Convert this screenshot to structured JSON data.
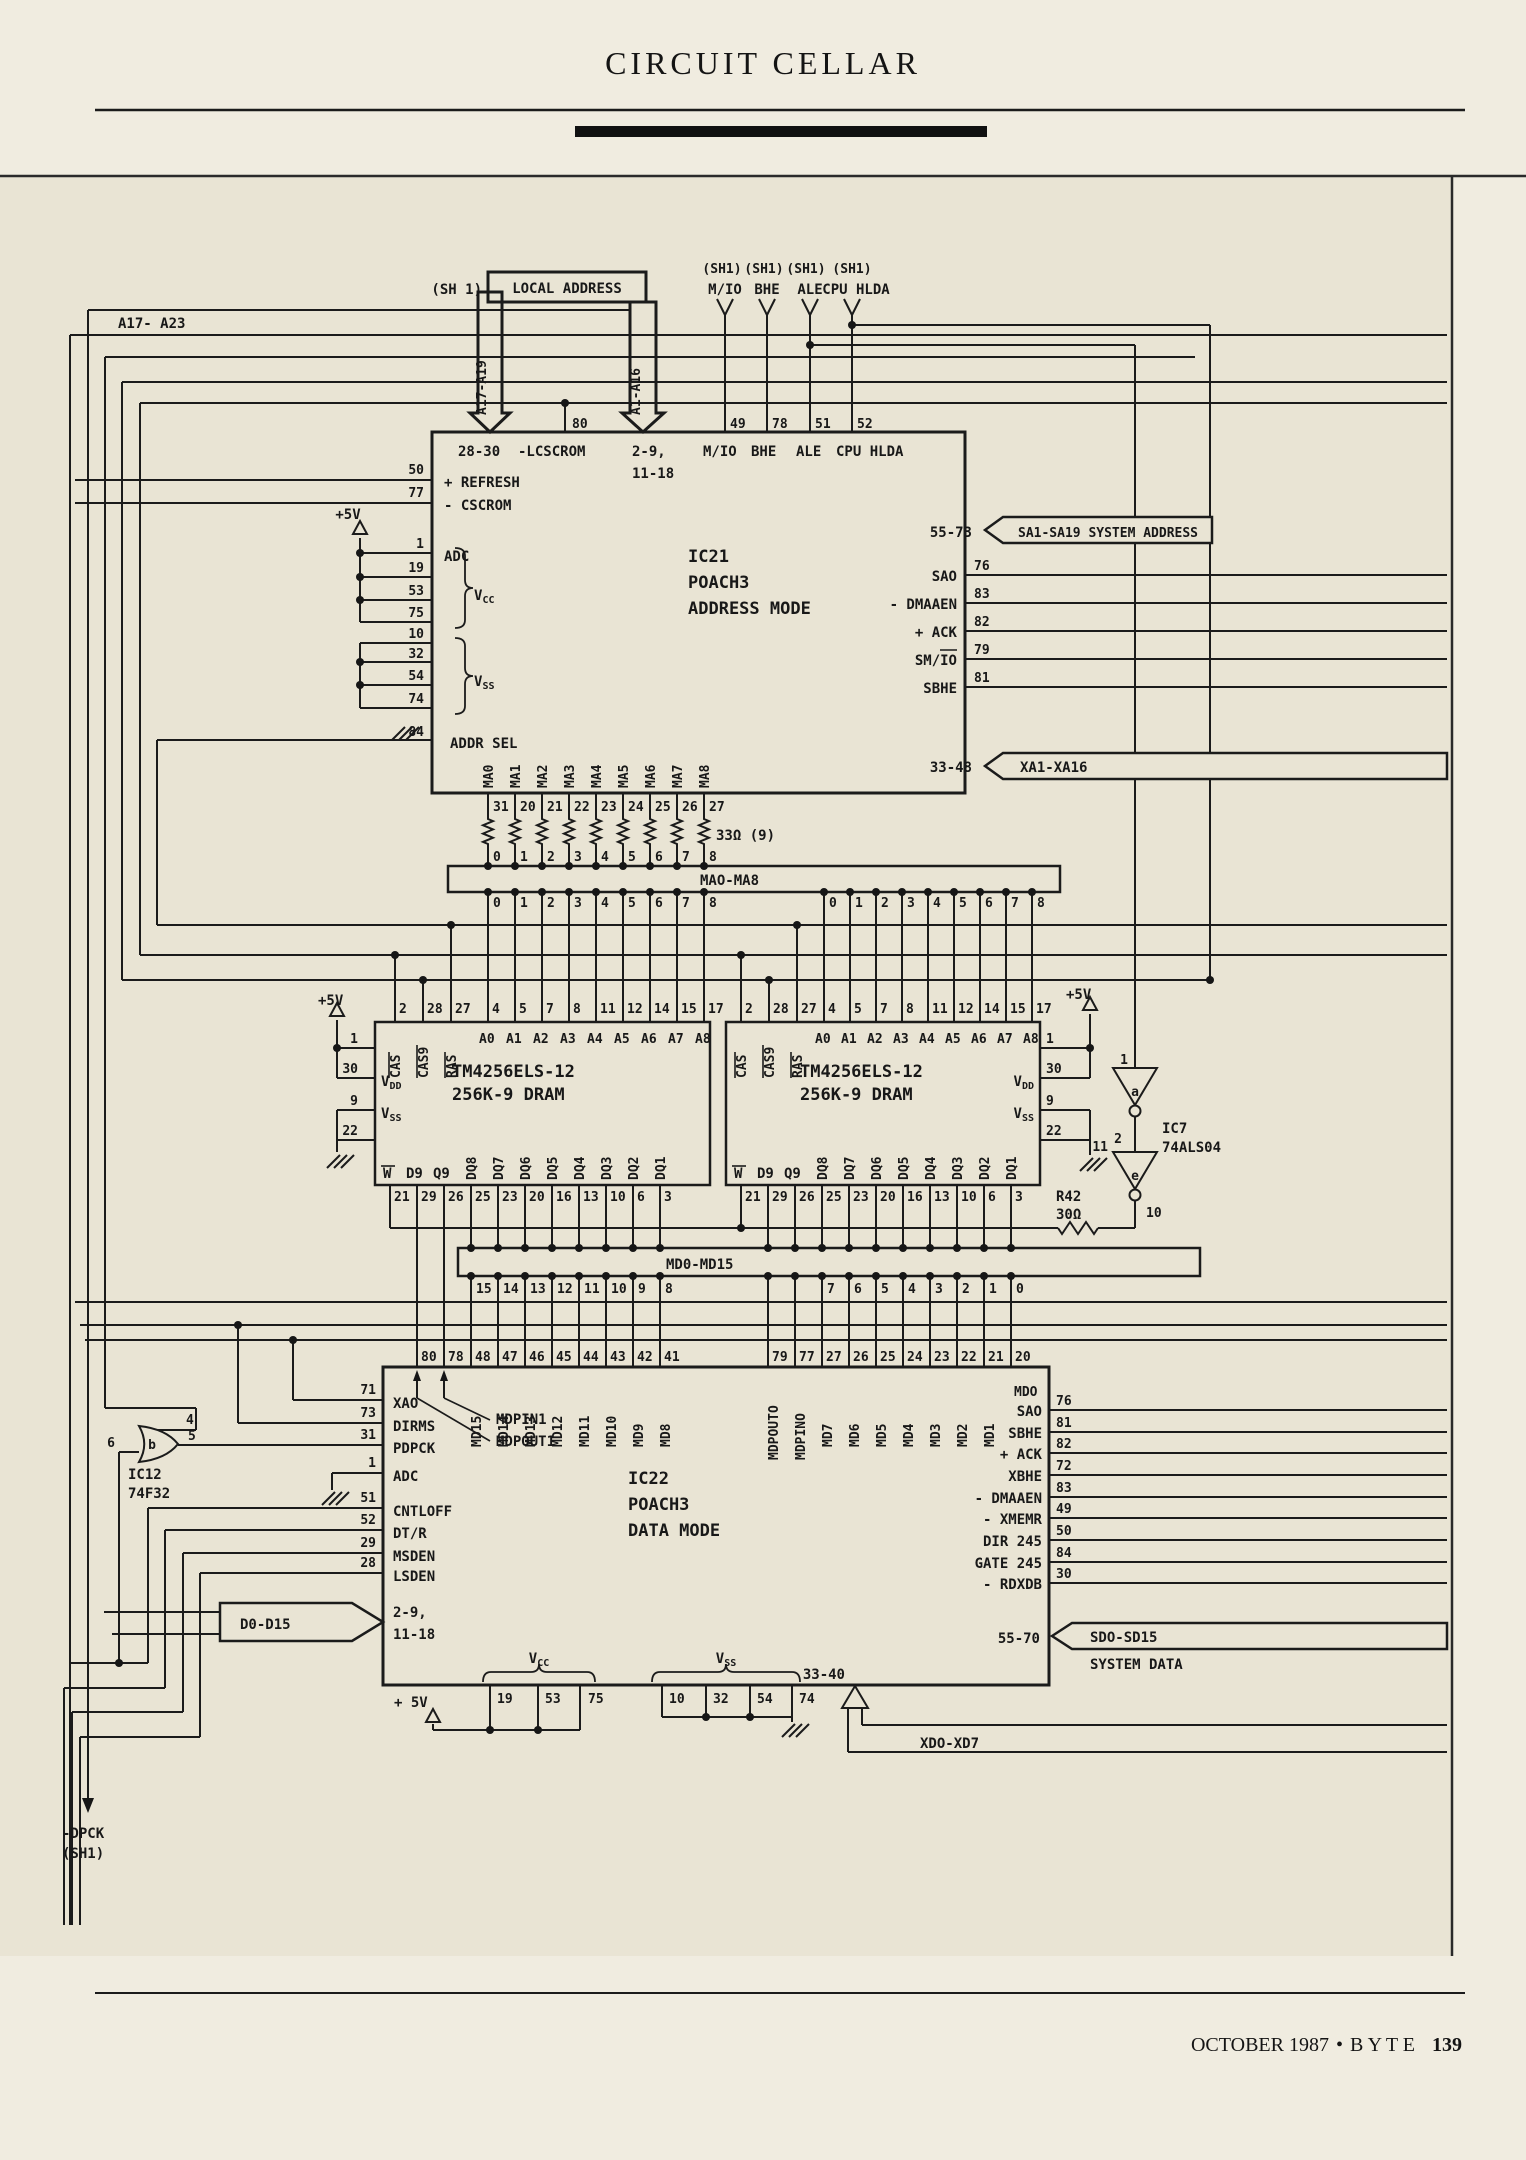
{
  "page": {
    "header_title": "CIRCUIT CELLAR",
    "footer_issue": "OCTOBER 1987",
    "footer_bullet": "•",
    "footer_magazine": "B Y T E",
    "footer_page": "139"
  },
  "top": {
    "sh1_left": "(SH 1)",
    "local_address": "LOCAL ADDRESS",
    "sh1_tags": [
      "(SH1)",
      "(SH1)",
      "(SH1)",
      "(SH1)"
    ],
    "cpu_signals": [
      "M/IO",
      "BHE",
      "ALE",
      "CPU HLDA"
    ],
    "bus_a17_a23": "A17- A23",
    "arrow_a17_a19": "A17-A19",
    "arrow_a1_a16": "A1-A16"
  },
  "ic21": {
    "ref": "IC21",
    "part": "POACH3",
    "mode": "ADDRESS MODE",
    "top_pin_range_left": "28-30",
    "top_lcscrom": "-LCSCROM",
    "top_pin_nums": [
      "80",
      "49",
      "78",
      "51",
      "52"
    ],
    "top_range_mid": "2-9,",
    "top_range_mid2": "11-18",
    "top_labels": [
      "M/IO",
      "BHE",
      "ALE",
      "CPU HLDA"
    ],
    "left_pins": [
      {
        "num": "50",
        "label": "+ REFRESH"
      },
      {
        "num": "77",
        "label": "- CSCROM"
      },
      {
        "num": "1",
        "label": "ADC"
      }
    ],
    "plus5v": "+5V",
    "vcc_pins": [
      "19",
      "53",
      "75"
    ],
    "vcc_label": "V",
    "vcc_sub": "CC",
    "vss_pins": [
      "10",
      "32",
      "54",
      "74"
    ],
    "vss_label": "V",
    "vss_sub": "SS",
    "addr_sel_num": "84",
    "addr_sel": "ADDR SEL",
    "right": {
      "sys_addr_range": "55-73",
      "sys_addr": "SA1-SA19  SYSTEM ADDRESS",
      "pins": [
        {
          "label": "SAO",
          "num": "76"
        },
        {
          "label": "- DMAAEN",
          "num": "83"
        },
        {
          "label": "+ ACK",
          "num": "82"
        },
        {
          "label": "SM/IO",
          "num": "79"
        },
        {
          "label": "SBHE",
          "num": "81"
        }
      ],
      "xa_range": "33-48",
      "xa": "XA1-XA16"
    },
    "bottom": {
      "ma_labels": [
        "MA0",
        "MA1",
        "MA2",
        "MA3",
        "MA4",
        "MA5",
        "MA6",
        "MA7",
        "MA8"
      ],
      "pin_nums": [
        "31",
        "20",
        "21",
        "22",
        "23",
        "24",
        "25",
        "26",
        "27"
      ],
      "resistor_note": "33Ω (9)",
      "bit_nums": [
        "0",
        "1",
        "2",
        "3",
        "4",
        "5",
        "6",
        "7",
        "8"
      ],
      "bus_label": "MAO-MA8"
    }
  },
  "dram": {
    "part1": "TM4256ELS-12",
    "part2": "256K-9 DRAM",
    "top_pin_nums": [
      "2",
      "28",
      "27",
      "4",
      "5",
      "7",
      "8",
      "11",
      "12",
      "14",
      "15",
      "17"
    ],
    "top_labels": [
      "CAS",
      "CAS9",
      "RAS",
      "A0",
      "A1",
      "A2",
      "A3",
      "A4",
      "A5",
      "A6",
      "A7",
      "A8"
    ],
    "left_pin_nums": [
      "1",
      "30",
      "9",
      "22"
    ],
    "plus5v": "+5V",
    "vdd": "V",
    "vdd_sub": "DD",
    "vss": "V",
    "vss_sub": "SS",
    "bottom_labels": [
      "W",
      "D9",
      "Q9",
      "DQ8",
      "DQ7",
      "DQ6",
      "DQ5",
      "DQ4",
      "DQ3",
      "DQ2",
      "DQ1"
    ],
    "bottom_pin_nums": [
      "21",
      "29",
      "26",
      "25",
      "23",
      "20",
      "16",
      "13",
      "10",
      "6",
      "3"
    ]
  },
  "ic7": {
    "ref": "IC7",
    "part": "74ALS04",
    "gate_a": "a",
    "gate_e": "e",
    "pin_in_a": "1",
    "pin_out_a": "2",
    "pin_in_e": "11",
    "pin_out_e": "10"
  },
  "r42": {
    "ref": "R42",
    "value": "30Ω"
  },
  "md_bus": {
    "label": "MD0-MD15",
    "left_bits": [
      "15",
      "14",
      "13",
      "12",
      "11",
      "10",
      "9",
      "8"
    ],
    "right_bits": [
      "7",
      "6",
      "5",
      "4",
      "3",
      "2",
      "1",
      "0"
    ]
  },
  "ic22": {
    "ref": "IC22",
    "part": "POACH3",
    "mode": "DATA MODE",
    "top_pin_nums": [
      "80",
      "78",
      "48",
      "47",
      "46",
      "45",
      "44",
      "43",
      "42",
      "41",
      "79",
      "77",
      "27",
      "26",
      "25",
      "24",
      "23",
      "22",
      "21",
      "20"
    ],
    "md_high": [
      "MD15",
      "MD14",
      "MD13",
      "MD12",
      "MD11",
      "MD10",
      "MD9",
      "MD8"
    ],
    "mdpout0": "MDPOUTO",
    "mdpin0": "MDPINO",
    "md_low": [
      "MD7",
      "MD6",
      "MD5",
      "MD4",
      "MD3",
      "MD2",
      "MD1"
    ],
    "md0": "MDO",
    "mdpin1": "MDPIN1",
    "mdpout1": "MDPOUT1",
    "left_pins": [
      {
        "num": "71",
        "label": "XAO"
      },
      {
        "num": "73",
        "label": "DIRMS"
      },
      {
        "num": "31",
        "label": "PDPCK"
      },
      {
        "num": "1",
        "label": "ADC"
      },
      {
        "num": "51",
        "label": "CNTLOFF"
      },
      {
        "num": "52",
        "label": "DT/R"
      },
      {
        "num": "29",
        "label": "MSDEN"
      },
      {
        "num": "28",
        "label": "LSDEN"
      }
    ],
    "d_bus": "D0-D15",
    "d_range1": "2-9,",
    "d_range2": "11-18",
    "right_pins": [
      {
        "label": "SAO",
        "num": "76"
      },
      {
        "label": "SBHE",
        "num": "81"
      },
      {
        "label": "+ ACK",
        "num": "82"
      },
      {
        "label": "XBHE",
        "num": "72"
      },
      {
        "label": "- DMAAEN",
        "num": "83"
      },
      {
        "label": "- XMEMR",
        "num": "49"
      },
      {
        "label": "DIR 245",
        "num": "50"
      },
      {
        "label": "GATE 245",
        "num": "84"
      },
      {
        "label": "- RDXDB",
        "num": "30"
      }
    ],
    "sd_range": "55-70",
    "sd_bus": "SDO-SD15",
    "sd_bus2": "SYSTEM DATA",
    "vcc_pins": [
      "19",
      "53",
      "75"
    ],
    "vcc_label": "V",
    "vcc_sub": "CC",
    "vss_pins": [
      "10",
      "32",
      "54",
      "74"
    ],
    "vss_label": "V",
    "vss_sub": "SS",
    "plus5v": "+ 5V",
    "xd_range": "33-40",
    "xd_bus": "XDO-XD7"
  },
  "ic12": {
    "ref": "IC12",
    "part": "74F32",
    "gate": "b",
    "pins": {
      "in1": "6",
      "in2": "4",
      "out": "5"
    }
  },
  "bottom_left": {
    "dpck": "-DPCK",
    "sh1": "(SH1)"
  }
}
